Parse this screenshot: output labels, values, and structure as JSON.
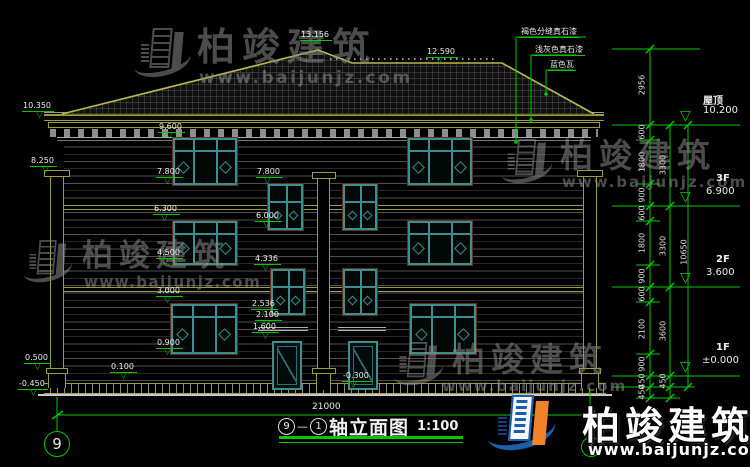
{
  "brand": {
    "name": "柏竣建筑",
    "url": "www.baijunjz.com"
  },
  "title_block": {
    "axis_start": "9",
    "axis_end": "1",
    "separator": "—",
    "name": "轴立面图",
    "scale": "1:100"
  },
  "grid_bubbles": {
    "left": "9",
    "right": "1"
  },
  "overall_width_dim": "21000",
  "material_labels": [
    "褐色分缝真石漆",
    "浅灰色真石漆",
    "蓝色瓦"
  ],
  "floor_labels": [
    {
      "name": "屋顶",
      "value": "10.200"
    },
    {
      "name": "3F",
      "value": "6.900"
    },
    {
      "name": "2F",
      "value": "3.600"
    },
    {
      "name": "1F",
      "value": "±0.000"
    }
  ],
  "elevation_markers": [
    {
      "label": "13.156",
      "x": 300,
      "y": 30,
      "tx": 10
    },
    {
      "label": "12.590",
      "x": 426,
      "y": 47,
      "tx": 10
    },
    {
      "label": "10.350",
      "x": 22,
      "y": 101,
      "tx": 14
    },
    {
      "label": "8.250",
      "x": 30,
      "y": 156,
      "tx": 12
    },
    {
      "label": "9.600",
      "x": 158,
      "y": 122,
      "tx": 8
    },
    {
      "label": "7.800",
      "x": 156,
      "y": 167,
      "tx": 8
    },
    {
      "label": "7.800",
      "x": 256,
      "y": 167,
      "tx": 8
    },
    {
      "label": "6.300",
      "x": 153,
      "y": 204,
      "tx": 8
    },
    {
      "label": "6.000",
      "x": 255,
      "y": 211,
      "tx": 8
    },
    {
      "label": "4.500",
      "x": 156,
      "y": 248,
      "tx": 6
    },
    {
      "label": "4.336",
      "x": 254,
      "y": 254,
      "tx": 8
    },
    {
      "label": "3.000",
      "x": 156,
      "y": 286,
      "tx": 8
    },
    {
      "label": "2.536",
      "x": 251,
      "y": 299,
      "tx": 10
    },
    {
      "label": "2.100",
      "x": 255,
      "y": 310,
      "tx": 8
    },
    {
      "label": "1.600",
      "x": 252,
      "y": 322,
      "tx": 10
    },
    {
      "label": "0.900",
      "x": 156,
      "y": 338,
      "tx": 8
    },
    {
      "label": "0.500",
      "x": 24,
      "y": 353,
      "tx": 10
    },
    {
      "label": "0.100",
      "x": 110,
      "y": 362,
      "tx": 10
    },
    {
      "label": "-0.450",
      "x": 18,
      "y": 379,
      "tx": 12
    },
    {
      "label": "-0.300",
      "x": 342,
      "y": 371,
      "tx": 8
    }
  ],
  "right_dim_texts": [
    {
      "v": "2956",
      "x": 642,
      "y": 85
    },
    {
      "v": "600",
      "x": 642,
      "y": 132
    },
    {
      "v": "1800",
      "x": 642,
      "y": 162
    },
    {
      "v": "900",
      "x": 642,
      "y": 195
    },
    {
      "v": "600",
      "x": 642,
      "y": 213
    },
    {
      "v": "1800",
      "x": 642,
      "y": 243
    },
    {
      "v": "900",
      "x": 642,
      "y": 276
    },
    {
      "v": "600",
      "x": 642,
      "y": 294
    },
    {
      "v": "2100",
      "x": 642,
      "y": 329
    },
    {
      "v": "900",
      "x": 642,
      "y": 364
    },
    {
      "v": "450",
      "x": 642,
      "y": 381
    },
    {
      "v": "450",
      "x": 642,
      "y": 392
    },
    {
      "v": "3300",
      "x": 663,
      "y": 165
    },
    {
      "v": "3300",
      "x": 663,
      "y": 246
    },
    {
      "v": "3600",
      "x": 663,
      "y": 331
    },
    {
      "v": "450",
      "x": 663,
      "y": 381
    },
    {
      "v": "10650",
      "x": 684,
      "y": 252
    }
  ],
  "colors": {
    "dim_green": "#00c800",
    "band_olive": "#9c9c3e",
    "window_teal": "#3d8f8f",
    "logo_blue": "#1a5fa8",
    "logo_orange": "#f08328",
    "background": "#000000"
  }
}
